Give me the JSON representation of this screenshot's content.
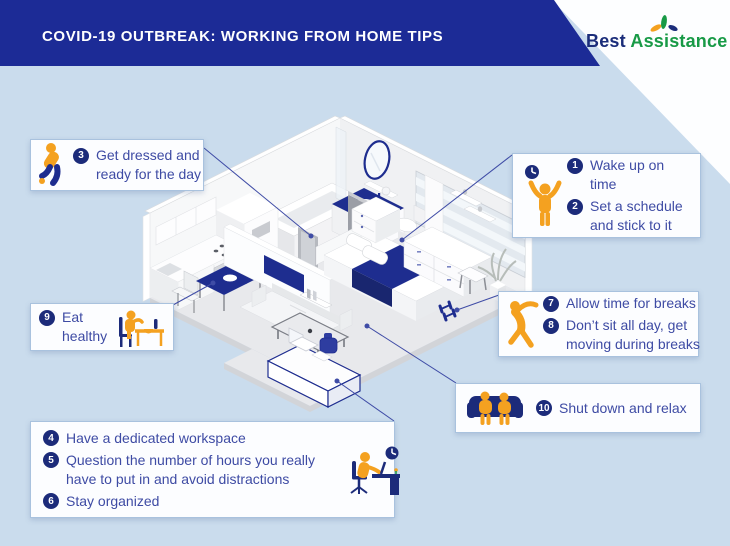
{
  "header": {
    "title": "COVID-19 OUTBREAK: WORKING FROM HOME TIPS"
  },
  "logo": {
    "word1": "Best",
    "word2": "Assistance"
  },
  "callouts": {
    "get_dressed": {
      "icon": "person-getting-dressed-icon",
      "items": [
        {
          "num": "3",
          "text": "Get dressed and ready for the day"
        }
      ]
    },
    "wake_up": {
      "icon": "person-arms-up-icon",
      "secondary_icon": "clock-icon",
      "items": [
        {
          "num": "1",
          "text": "Wake up on time"
        },
        {
          "num": "2",
          "text": "Set a schedule and stick to it"
        }
      ]
    },
    "breaks": {
      "icon": "person-stretching-icon",
      "items": [
        {
          "num": "7",
          "text": "Allow time for breaks"
        },
        {
          "num": "8",
          "text": "Don’t sit all day, get moving during breaks"
        }
      ]
    },
    "eat_healthy": {
      "icon": "person-eating-icon",
      "items": [
        {
          "num": "9",
          "text": "Eat healthy"
        }
      ]
    },
    "shut_down": {
      "icon": "couple-on-couch-icon",
      "items": [
        {
          "num": "10",
          "text": "Shut down and relax"
        }
      ]
    },
    "workspace": {
      "icon": "person-at-desk-icon",
      "secondary_icon": "clock-icon",
      "items": [
        {
          "num": "4",
          "text": "Have a dedicated workspace"
        },
        {
          "num": "5",
          "text": "Question the number of hours you really have to put in and avoid distractions"
        },
        {
          "num": "6",
          "text": "Stay organized"
        }
      ]
    }
  },
  "illustration": {
    "description": "isometric cutaway apartment",
    "rooms": [
      "kitchen",
      "bathroom",
      "bedroom",
      "living room",
      "home office corner"
    ]
  },
  "colors": {
    "c-header": "#1c2b96",
    "c-navy": "#1e2d8f",
    "c-badge": "#1c2b7a",
    "c-text": "#3e4ba4",
    "c-orange": "#f4a120",
    "c-bg": "#cadced",
    "c-green": "#189a46",
    "c-border": "#a9c2de",
    "c-line": "#3f4ca6"
  }
}
